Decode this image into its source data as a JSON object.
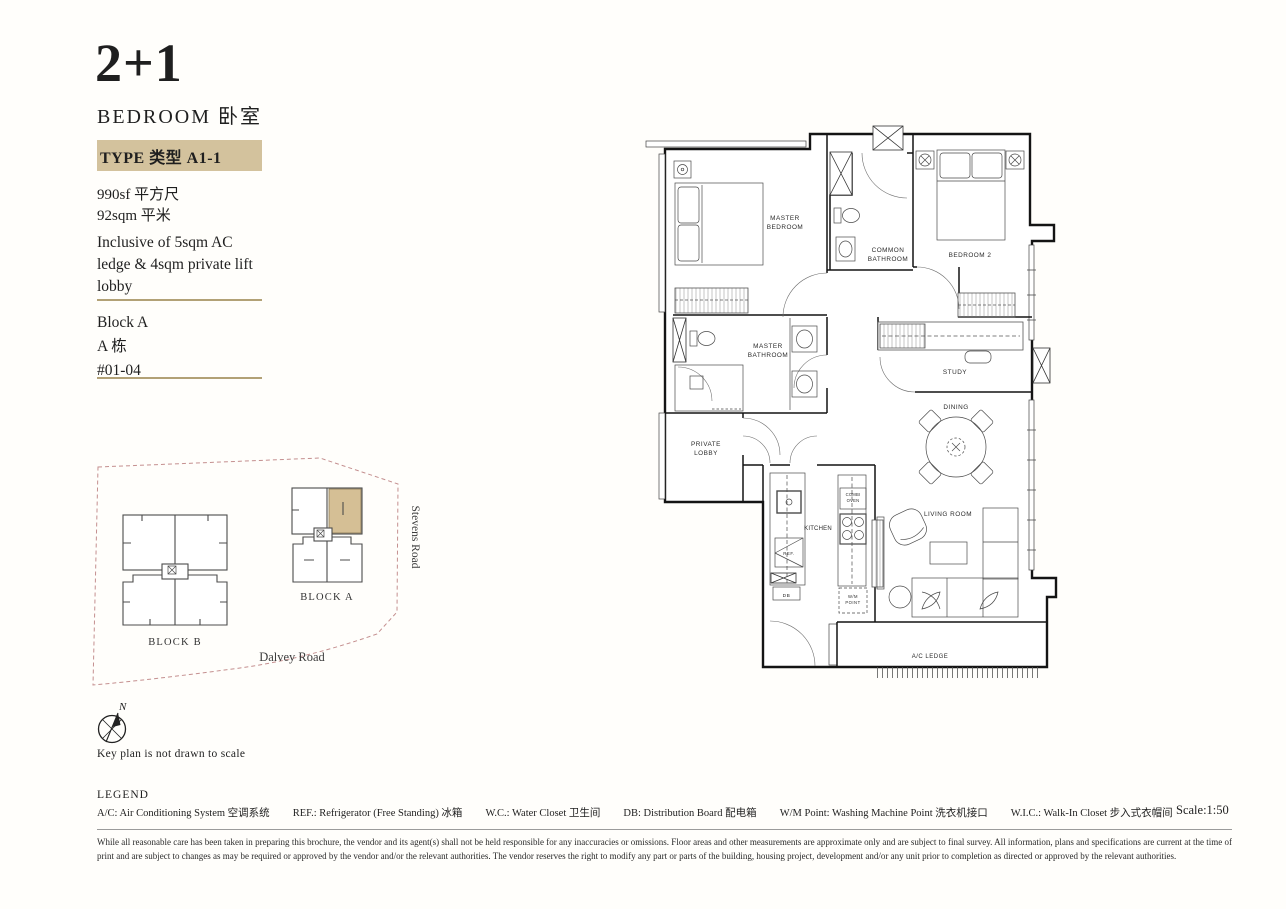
{
  "title": {
    "main": "2+1",
    "sub": "BEDROOM 卧室"
  },
  "type_banner": "TYPE 类型 A1-1",
  "area": {
    "imperial": "990sf 平方尺",
    "metric": "92sqm 平米",
    "note": "Inclusive of 5sqm AC ledge & 4sqm private lift lobby"
  },
  "unit": {
    "block": "Block A",
    "block_cn": "A 栋",
    "number": "#01-04"
  },
  "keyplan": {
    "block_a": "BLOCK A",
    "block_b": "BLOCK B",
    "road_side": "Stevens Road",
    "road_bottom": "Dalvey Road",
    "compass": "N",
    "note": "Key plan is not drawn to scale",
    "highlight_color": "#d5bf95",
    "boundary_color": "#c48f8f"
  },
  "plan": {
    "master_bedroom": [
      "MASTER",
      "BEDROOM"
    ],
    "common_bathroom": [
      "COMMON",
      "BATHROOM"
    ],
    "bedroom_2": "BEDROOM 2",
    "master_bathroom": [
      "MASTER",
      "BATHROOM"
    ],
    "private_lobby": [
      "PRIVATE",
      "LOBBY"
    ],
    "study": "STUDY",
    "dining": "DINING",
    "kitchen": "KITCHEN",
    "living_room": "LIVING ROOM",
    "ac_ledge": "A/C LEDGE",
    "combi_oven": [
      "COMBI",
      "OVEN"
    ],
    "ref": "REF.",
    "db": "DB",
    "wm_point": [
      "W/M",
      "POINT"
    ]
  },
  "legend": {
    "title": "LEGEND",
    "items": [
      "A/C: Air Conditioning System 空调系统",
      "REF.: Refrigerator (Free Standing) 冰箱",
      "W.C.: Water Closet 卫生间",
      "DB: Distribution Board 配电箱",
      "W/M Point: Washing Machine Point 洗衣机接口",
      "W.I.C.: Walk-In Closet 步入式衣帽间"
    ],
    "scale": "Scale:1:50"
  },
  "disclaimer": "While all reasonable care has been taken in preparing this brochure, the vendor and its agent(s) shall not be held responsible for any inaccuracies or omissions. Floor areas and other measurements are approximate only and are subject to final survey. All information, plans and specifications are current at the time of print and are subject to changes as may be required or approved by the vendor and/or the relevant authorities. The vendor reserves the right to modify any part or parts of the building, housing project, development and/or any unit prior to completion as directed or approved by the relevant authorities."
}
